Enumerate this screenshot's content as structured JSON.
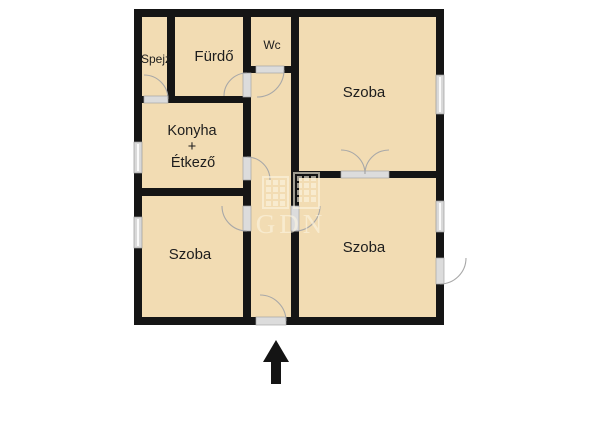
{
  "floorplan": {
    "rooms": {
      "pantry": {
        "label": "Spejz"
      },
      "bathroom": {
        "label": "Fürdő"
      },
      "wc": {
        "label": "Wc"
      },
      "room_top_right": {
        "label": "Szoba"
      },
      "kitchen_dining": {
        "line1": "Konyha",
        "line2": "+",
        "line3": "Étkező"
      },
      "room_bottom_left": {
        "label": "Szoba"
      },
      "room_bottom_right": {
        "label": "Szoba"
      }
    },
    "watermark": {
      "text": "GDN"
    },
    "colors": {
      "background": "#ffffff",
      "floor": "#f2dcb3",
      "wall": "#151515",
      "opening": "#dcdcdc",
      "window": "#d9d9d9",
      "arc": "#a8a8a8",
      "label": "#1d1d1d",
      "arrow": "#141414",
      "watermark": "#fdf6e3"
    }
  }
}
